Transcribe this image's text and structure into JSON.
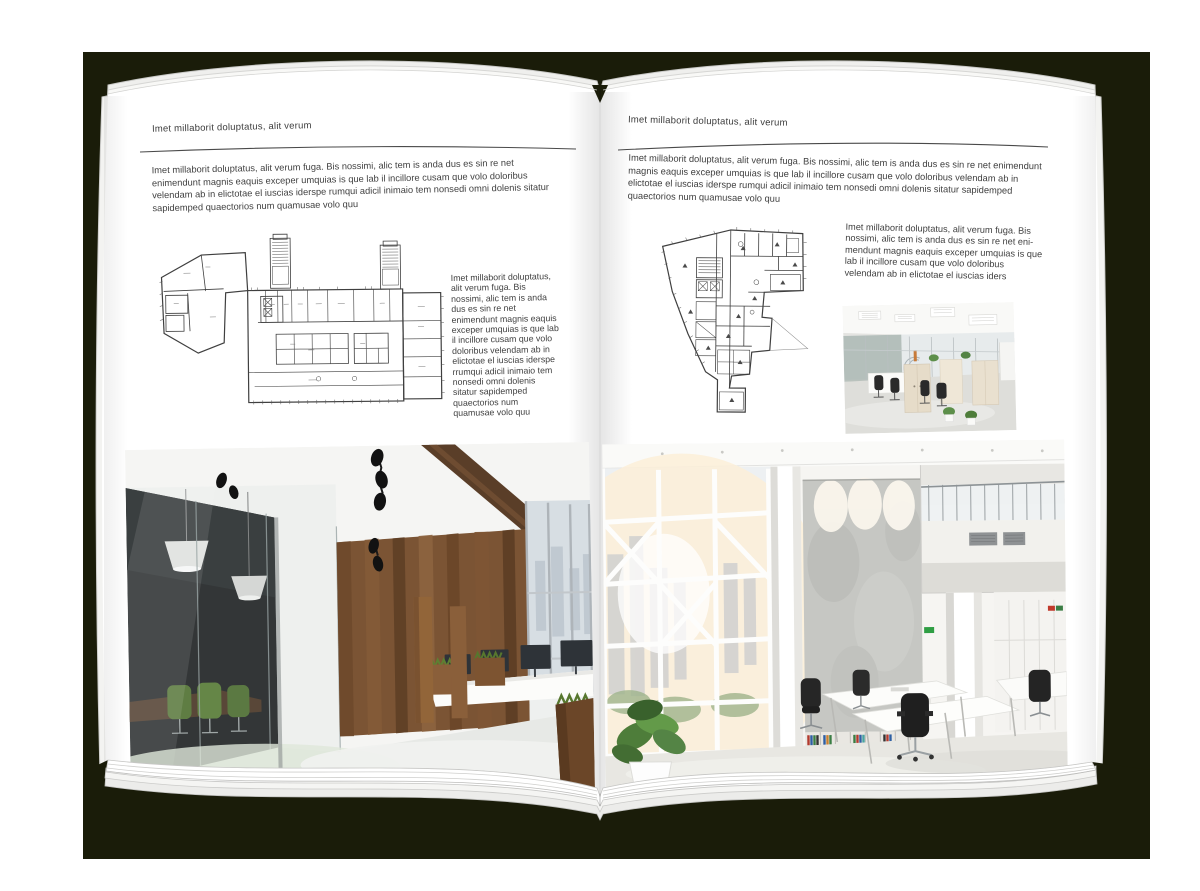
{
  "left_page": {
    "header": "Imet millaborit doluptatus, alit verum",
    "intro": "Imet millaborit doluptatus, alit verum fuga. Bis nossimi, alic tem is anda dus es sin re net enimendunt magnis eaquis exceper umquias is que lab il incillore cusam que volo doloribus velendam ab in elictotae el iuscias iderspe rumqui adicil inimaio tem nonsedi omni dolenis sitatur sapidemped quaectorios num quamusae volo quu",
    "side_text": "Imet millaborit doluptatus, alit verum fuga. Bis nossimi, alic tem is anda dus es sin re net enimendunt magnis eaquis exceper umquias is que lab il incillore cusam que volo doloribus velendam ab in elictotae el iuscias iderspe rrumqui adicil inimaio tem nonsedi omni dolenis sitatur sapidemped quaectorios num quamusae volo quu"
  },
  "right_page": {
    "header": "Imet millaborit doluptatus, alit verum",
    "intro": "Imet millaborit doluptatus, alit verum fuga. Bis nossimi, alic tem is anda dus es sin re net enimendunt magnis eaquis exceper umquias is que lab il incillore cusam que volo doloribus velendam ab in elictotae el iuscias iderspe rumqui adicil inimaio tem nonsedi omni dolenis sitatur sapidemped quaectorios num quamusae volo quu",
    "side_text": "Imet millaborit doluptatus, alit verum fuga. Bis nossimi, alic tem is anda dus es sin re net eni-mendunt magnis eaquis exceper umquias is que lab il incillore cusam que volo doloribus velendam ab in elictotae el iuscias iders"
  },
  "colors": {
    "backdrop": "#1a1c09",
    "page": "#ffffff",
    "body_text": "#3f3f3f",
    "wood_accent": "#7b5434",
    "plant_green": "#4e7d3a"
  }
}
